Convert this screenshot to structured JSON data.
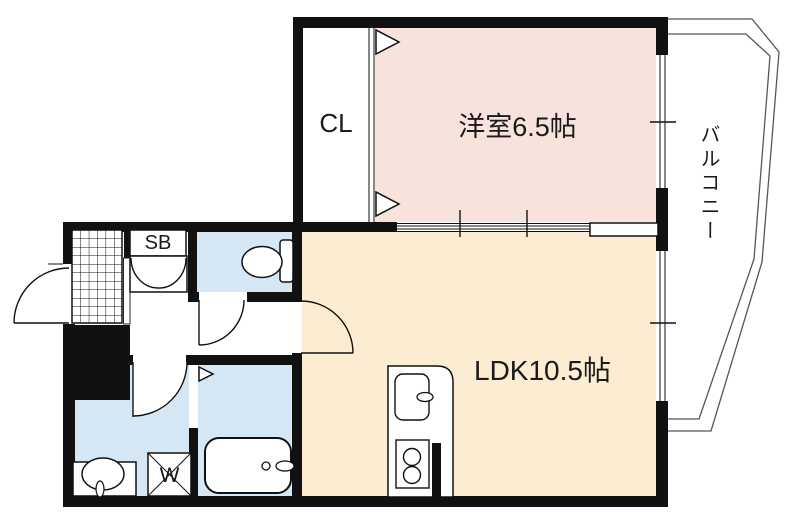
{
  "floorplan": {
    "labels": {
      "bedroom": "洋室6.5帖",
      "ldk": "LDK10.5帖",
      "closet": "CL",
      "shoe_box": "SB",
      "washer": "W",
      "balcony": "バルコニー"
    },
    "colors": {
      "bedroom": "#f8e3dc",
      "ldk": "#fcecd2",
      "wet": "#d5e7f5",
      "wall": "#111111",
      "balcony_line": "#555555"
    }
  }
}
